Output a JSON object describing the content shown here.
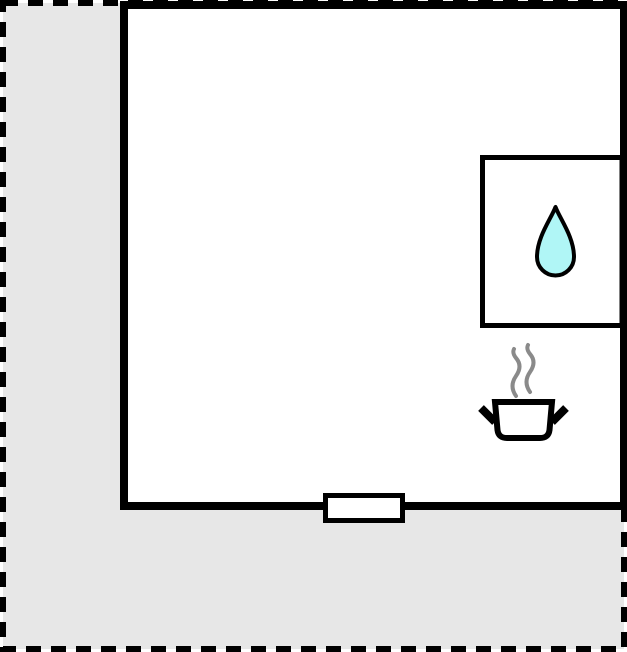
{
  "scene": {
    "kind": "floor-plan",
    "colors": {
      "plot_fill": "#e7e7e7",
      "boundary_stroke": "#000000",
      "room_fill": "#ffffff",
      "wall_stroke": "#000000",
      "partition_fill": "#ffffff",
      "opening_fill": "#ffffff",
      "drop_fill": "#b0f6f6",
      "drop_stroke": "#000000",
      "pot_fill": "#ffffff",
      "pot_stroke": "#000000",
      "steam_stroke": "#8a8a8a"
    },
    "icons": [
      {
        "name": "water-drop-icon"
      },
      {
        "name": "cooking-pot-icon"
      },
      {
        "name": "steam-icon"
      }
    ],
    "shapes": [
      {
        "name": "plot-boundary"
      },
      {
        "name": "room-outline"
      },
      {
        "name": "annex-partition"
      },
      {
        "name": "wall-opening"
      }
    ]
  }
}
